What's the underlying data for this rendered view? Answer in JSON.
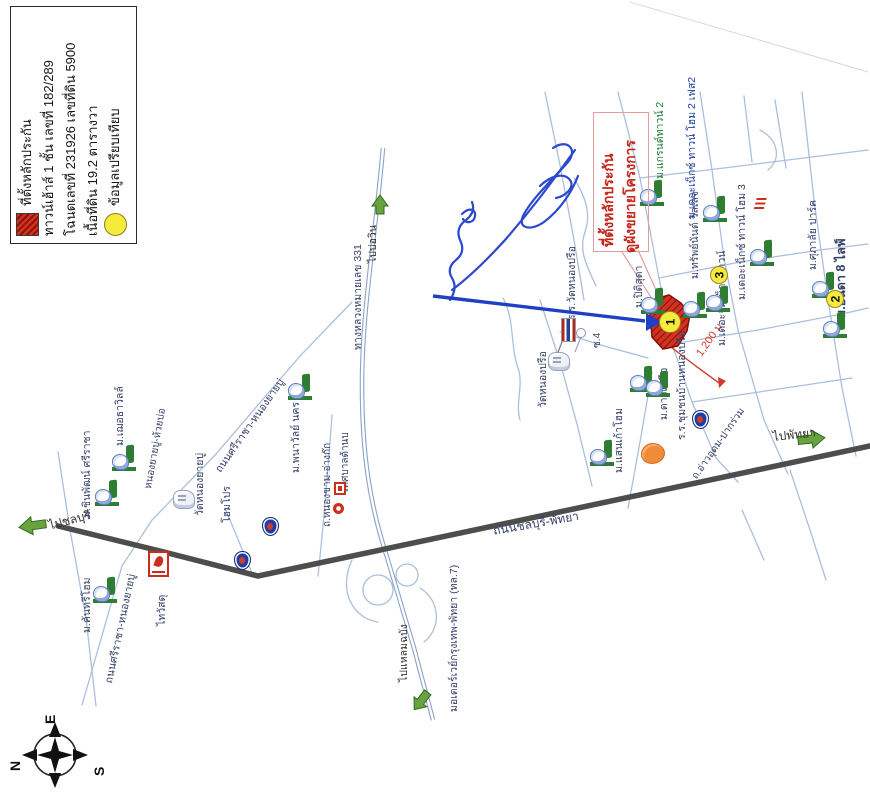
{
  "legend": {
    "items": [
      {
        "icon": "collateral-swatch",
        "text": "ที่ตั้งหลักประกัน"
      },
      {
        "icon": null,
        "text": "ทาวน์เฮ้าส์ 1 ชั้น เลขที่ 182/289"
      },
      {
        "icon": null,
        "text": "โฉนดเลขที่ 231926 เลขที่ดิน 5900"
      },
      {
        "icon": null,
        "text": "เนื้อที่ดิน 19.2 ตารางวา"
      },
      {
        "icon": "comparable-swatch",
        "text": "ข้อมูลเปรียบเทียบ"
      }
    ]
  },
  "callout": {
    "line1": "ที่ตั้งหลักประกัน",
    "line2": "ดูผังขยายโครงการ",
    "distance_label": "1,200 ม."
  },
  "compass": {
    "top": "E",
    "left": "N",
    "right": "S"
  },
  "colors": {
    "collateral_red": "#d23222",
    "comparable_yellow": "#f6ea3c",
    "route_red": "#cf3b2a",
    "ink_blue": "#2b49cc",
    "road_dark": "#4d4d4d",
    "road_light": "#aabfdd",
    "green_arrow": "#69a33f"
  },
  "map_texts": [
    {
      "name": "road-hwy331-label",
      "text": "ทางหลวงหมายเลข 331",
      "x": 352,
      "y": 350,
      "rot": -90
    },
    {
      "name": "dir-bowin-label",
      "text": "ไปบ่อวิน",
      "x": 367,
      "y": 263,
      "rot": -90,
      "color": "#333333"
    },
    {
      "name": "road-motorway-label",
      "text": "มอเตอร์เวย์กรุงเทพ-พัทยา (ทล.7)",
      "x": 448,
      "y": 712,
      "rot": -90
    },
    {
      "name": "dir-laemchabang-label",
      "text": "ไปแหลมฉบัง",
      "x": 398,
      "y": 682,
      "rot": -90,
      "color": "#333333"
    },
    {
      "name": "road-chonburi-pattaya-label",
      "text": "ถนนชลบุรี-พัทยา",
      "x": 492,
      "y": 524,
      "rot": -10,
      "size": 12
    },
    {
      "name": "dir-pattaya-label",
      "text": "ไปพัทยา",
      "x": 772,
      "y": 430,
      "rot": -6,
      "size": 12,
      "color": "#333333"
    },
    {
      "name": "dir-chonburi-label",
      "text": "ไปชลบุรี",
      "x": 47,
      "y": 519,
      "rot": -15,
      "size": 12,
      "color": "#333333"
    },
    {
      "name": "road-sriracha-nongyaibu-label",
      "text": "ถนนศรีราชา-หนองยายบู่",
      "x": 213,
      "y": 468,
      "rot": -55
    },
    {
      "name": "road-sriracha-nongyaibu-label-2",
      "text": "ถนนศรีราชา-หนองยายบู่",
      "x": 103,
      "y": 682,
      "rot": -78
    },
    {
      "name": "road-nongyaibu-huaibo-label",
      "text": "หนองยายบู่-ห้วยบ่อ",
      "x": 143,
      "y": 488,
      "rot": -80,
      "size": 10
    },
    {
      "name": "road-nongkham-angkok-label",
      "text": "ถ.หนองขาม-อ่างก๊ก",
      "x": 322,
      "y": 527,
      "rot": -90,
      "size": 10
    },
    {
      "name": "tessaban-label",
      "text": "เทศบาลด้านบ",
      "x": 340,
      "y": 492,
      "rot": -90,
      "size": 10
    },
    {
      "name": "soi-4-label",
      "text": "ซ.4",
      "x": 592,
      "y": 348,
      "rot": -90,
      "size": 10
    },
    {
      "name": "road-aoudom-pakruam-label",
      "text": "ถ.อ่าวอุดม-ปากร่วม",
      "x": 690,
      "y": 475,
      "rot": -55,
      "size": 10
    },
    {
      "name": "distance-label",
      "text": "1,200 ม.",
      "x": 694,
      "y": 352,
      "rot": -55,
      "color": "#cf3b2a",
      "size": 11
    },
    {
      "name": "school-wat-nongprue-label",
      "text": "ร.ร.วัดหนองปรือ",
      "x": 566,
      "y": 320,
      "rot": -90
    },
    {
      "name": "wat-nongprue-label",
      "text": "วัดหนองปรือ",
      "x": 537,
      "y": 408,
      "rot": -90
    },
    {
      "name": "school-chumchon-nongprue-label",
      "text": "ร.ร.ชุมชนบ้านหนองปรือ",
      "x": 676,
      "y": 440,
      "rot": -90
    },
    {
      "name": "mu-dao-nuea-label",
      "text": "ม.ดาวเหนือ",
      "x": 658,
      "y": 420,
      "rot": -90
    },
    {
      "name": "mu-saen-kao-home-label",
      "text": "ม.แสนเก้าโฮม",
      "x": 613,
      "y": 473,
      "rot": -90
    },
    {
      "name": "mu-piti-suda-label",
      "text": "ม.ปิติสุดา",
      "x": 633,
      "y": 308,
      "rot": -90
    },
    {
      "name": "mu-sap-nant-village-label",
      "text": "ม.ทรัพย์นันต์ วิลเลจ",
      "x": 689,
      "y": 279,
      "rot": -90
    },
    {
      "name": "mu-the-jump-next-town-label",
      "text": "ม.เดอะจั๊มเน็กซ์ทาวน์",
      "x": 716,
      "y": 346,
      "rot": -90
    },
    {
      "name": "mu-the-next-town-home-2-label",
      "text": "ม.เดอะเน็กซ์ ทาวน์ โฮม 2 เฟส2",
      "x": 686,
      "y": 219,
      "rot": -90,
      "color": "#1d3f9e"
    },
    {
      "name": "mu-grand-town-2-label",
      "text": "ม.แกรนด์ทาวน์ 2",
      "x": 654,
      "y": 179,
      "rot": -90,
      "color": "#1c7a2e"
    },
    {
      "name": "mu-the-next-town-home-3-label",
      "text": "ม.เดอะเน็กซ์ ทาวน์ โฮม 3",
      "x": 736,
      "y": 300,
      "rot": -90
    },
    {
      "name": "mu-supalai-park-label",
      "text": "ม.ศุภาลัย ปาร์ค",
      "x": 807,
      "y": 270,
      "rot": -90
    },
    {
      "name": "mu-anda-8-life-label",
      "text": "ม.อันดา 8 ไลฟ์",
      "x": 834,
      "y": 318,
      "rot": -90,
      "size": 12.5,
      "bold": true
    },
    {
      "name": "mu-panawan-nakhon-label",
      "text": "ม.พนาวัลย์ นคร",
      "x": 290,
      "y": 473,
      "rot": -90
    },
    {
      "name": "mu-chinnaphat-sriracha-label",
      "text": "ม.ชินพัฒน์ ศรีราชา",
      "x": 81,
      "y": 518,
      "rot": -90
    },
    {
      "name": "mu-choetha-ville-label",
      "text": "ม.เฌอธาวิลล์",
      "x": 114,
      "y": 446,
      "rot": -90
    },
    {
      "name": "wat-nongyaibu-label",
      "text": "วัดหนองยายบู่",
      "x": 194,
      "y": 516,
      "rot": -90
    },
    {
      "name": "homepro-label",
      "text": "โฮมโปร",
      "x": 221,
      "y": 523,
      "rot": -90
    },
    {
      "name": "thai-watsadu-label",
      "text": "ไทวัสดุ",
      "x": 156,
      "y": 626,
      "rot": -90
    },
    {
      "name": "mu-country-home-label",
      "text": "ม.คันทรีโฮม",
      "x": 81,
      "y": 633,
      "rot": -90
    }
  ],
  "icons": [
    {
      "type": "estate",
      "x": 640,
      "y": 180
    },
    {
      "type": "estate",
      "x": 703,
      "y": 196
    },
    {
      "type": "estate",
      "x": 750,
      "y": 240
    },
    {
      "type": "estate",
      "x": 683,
      "y": 292
    },
    {
      "type": "estate",
      "x": 706,
      "y": 286
    },
    {
      "type": "estate",
      "x": 812,
      "y": 272
    },
    {
      "type": "estate",
      "x": 823,
      "y": 312
    },
    {
      "type": "estate",
      "x": 641,
      "y": 288
    },
    {
      "type": "estate",
      "x": 630,
      "y": 366
    },
    {
      "type": "estate",
      "x": 646,
      "y": 371
    },
    {
      "type": "estate",
      "x": 590,
      "y": 440
    },
    {
      "type": "estate",
      "x": 288,
      "y": 374
    },
    {
      "type": "estate",
      "x": 95,
      "y": 480
    },
    {
      "type": "estate",
      "x": 112,
      "y": 445
    },
    {
      "type": "estate",
      "x": 93,
      "y": 577
    },
    {
      "type": "temple",
      "x": 548,
      "y": 352
    },
    {
      "type": "temple",
      "x": 173,
      "y": 490
    },
    {
      "type": "ptt",
      "x": 262,
      "y": 517
    },
    {
      "type": "ptt",
      "x": 234,
      "y": 551
    },
    {
      "type": "ptt",
      "x": 692,
      "y": 410
    },
    {
      "type": "thaiwatsadu",
      "x": 148,
      "y": 551
    },
    {
      "type": "orange",
      "x": 641,
      "y": 443
    },
    {
      "type": "redsquare",
      "x": 334,
      "y": 482
    },
    {
      "type": "redflower",
      "x": 333,
      "y": 503
    },
    {
      "type": "redmark",
      "x": 755,
      "y": 198
    },
    {
      "type": "flag",
      "x": 561,
      "y": 342,
      "rot": -90
    }
  ],
  "badges": [
    {
      "label": "1",
      "x": 670,
      "y": 322,
      "r": 11
    },
    {
      "label": "2",
      "x": 835,
      "y": 299,
      "r": 9
    },
    {
      "label": "3",
      "x": 719,
      "y": 275,
      "r": 9
    }
  ]
}
